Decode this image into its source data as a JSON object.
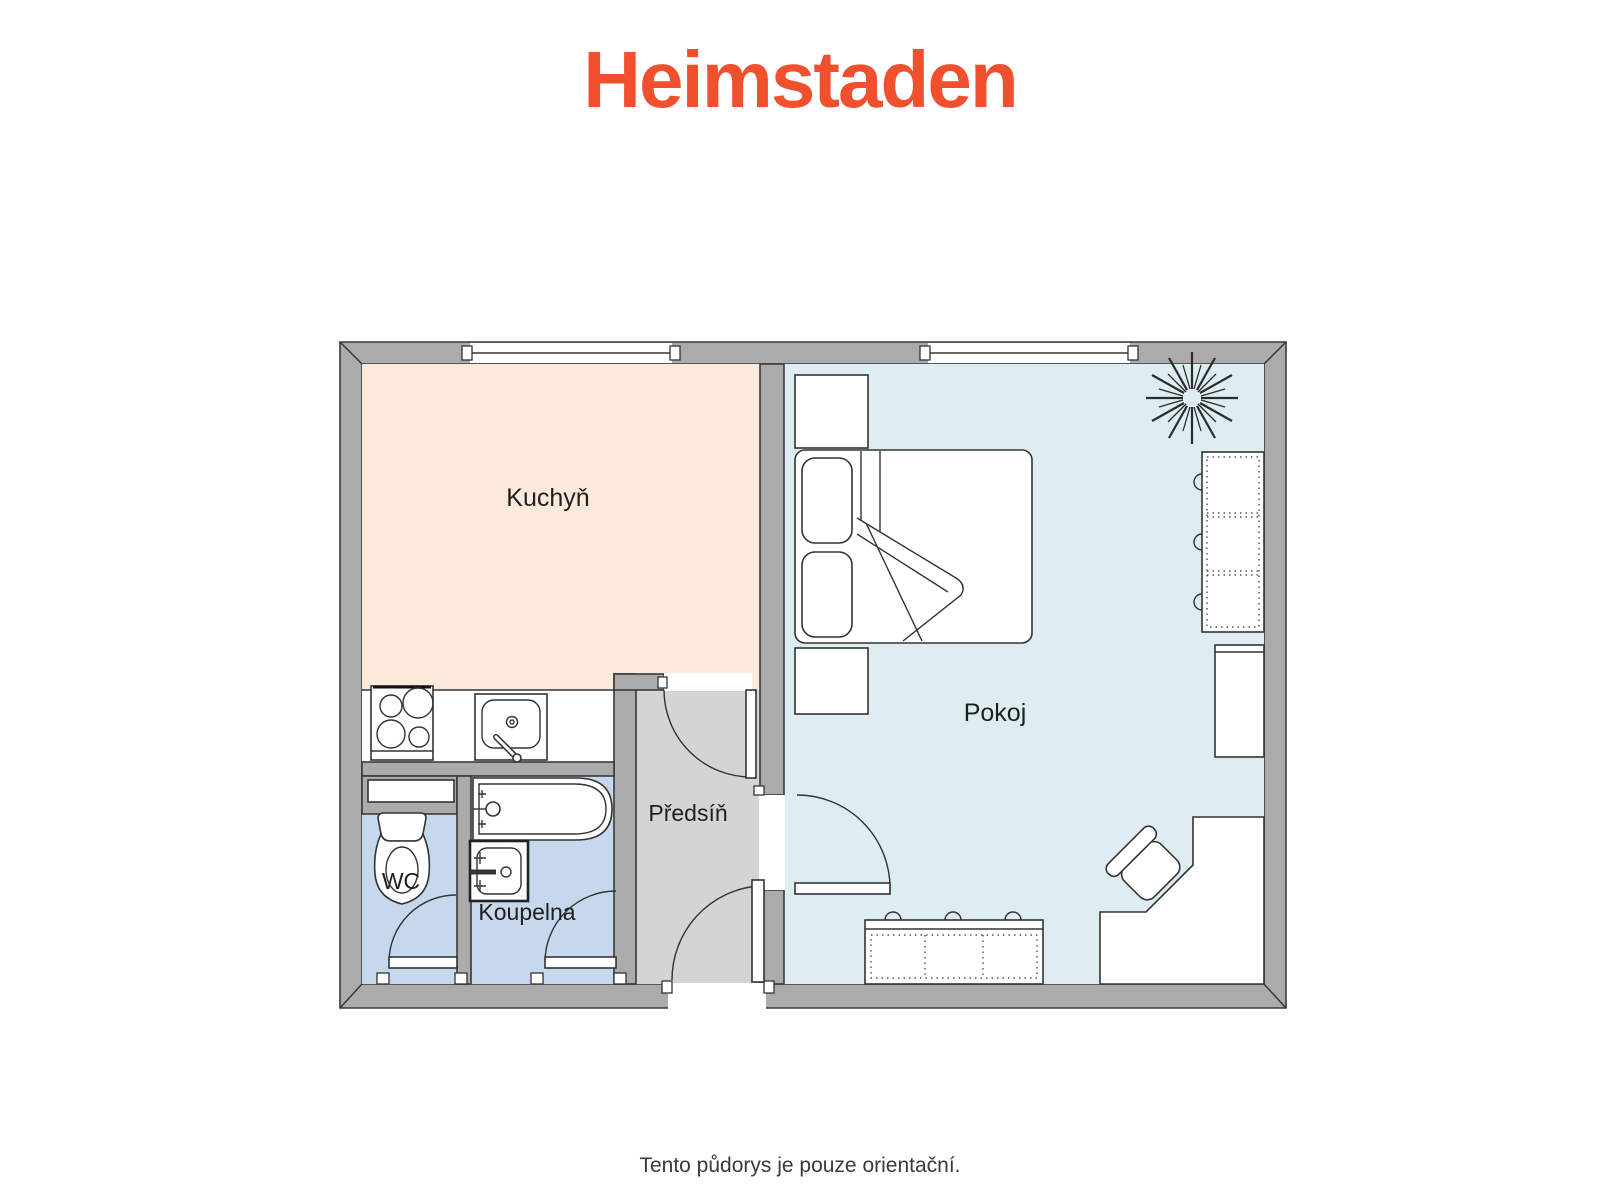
{
  "logo": {
    "text": "Heimstaden",
    "color": "#F0502D"
  },
  "floor_plan": {
    "wall_color": "#ABABAB",
    "outline_color": "#3A3A3A",
    "label_color": "#1F1F1F",
    "rooms": [
      {
        "id": "kuchyn",
        "label": "Kuchyň",
        "fill": "#FBE9DA"
      },
      {
        "id": "pokoj",
        "label": "Pokoj",
        "fill": "#DEEDF2"
      },
      {
        "id": "predsin",
        "label": "Předsíň",
        "fill": "#D4D4D4"
      },
      {
        "id": "wc",
        "label": "WC",
        "fill": "#C6D8EC"
      },
      {
        "id": "koupelna",
        "label": "Koupelna",
        "fill": "#C6D8EC"
      }
    ],
    "furniture": [
      "stove",
      "kitchen-sink",
      "bathtub",
      "washbasin",
      "toilet",
      "shelf",
      "bed",
      "pillow",
      "nightstand",
      "wardrobe",
      "cabinet",
      "dresser",
      "desk",
      "chair",
      "plant",
      "window",
      "door"
    ]
  },
  "footer": {
    "disclaimer": "Tento půdorys je pouze orientační."
  }
}
